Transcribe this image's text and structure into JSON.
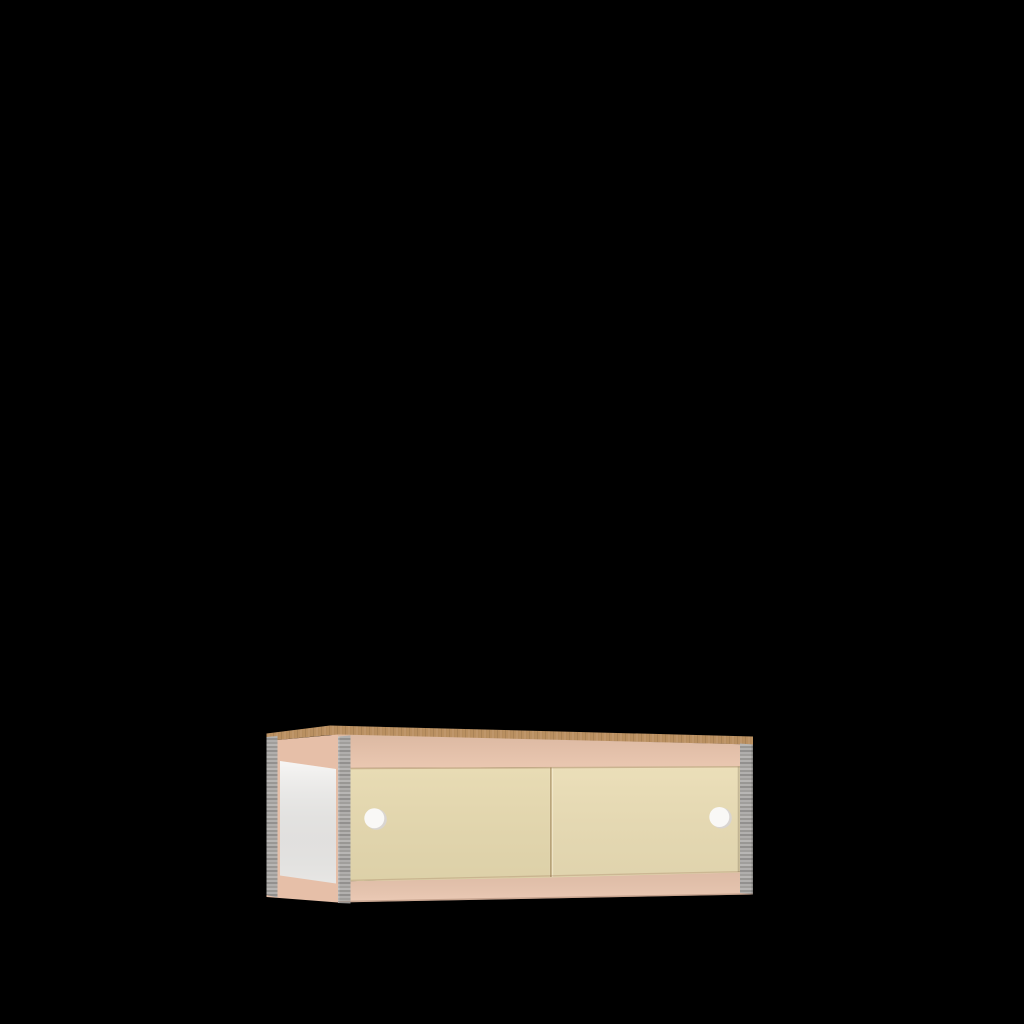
{
  "scene": {
    "background": "#000000",
    "subject": "low wall cabinet with two sliding doors",
    "view": "three-quarter front-left product render"
  },
  "cabinet": {
    "door_count": 2,
    "handle_count": 2,
    "colors": {
      "wood_top": "#ba9061",
      "frame": "#e9c4ac",
      "frame_side": "#e6bfa8",
      "frame_bottom": "#eac6af",
      "door_left": "#e7dab0",
      "door_right": "#eaddb5",
      "side_panel": "#f4f3f1",
      "edge_gray": "#aaa8a5",
      "handle": "#f9f8f6",
      "handle_shadow": "#d9d5d1"
    }
  }
}
